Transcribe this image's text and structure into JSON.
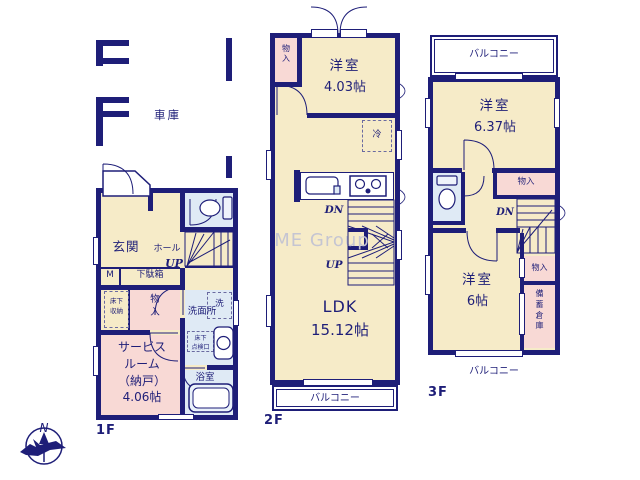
{
  "colors": {
    "wall": "#1e1e78",
    "room_cream": "#f6ebc8",
    "closet_pink": "#f8d9d5",
    "wet_blue": "#dfeaf5",
    "watermark_gray": "#c5c5d2"
  },
  "watermark": "ME Group",
  "compass": {
    "north": "N"
  },
  "f1": {
    "floor_label": "1F",
    "garage": "車庫",
    "genkan": "玄関",
    "hall": "ホール",
    "up": "UP",
    "meter": "M",
    "shoe_box": "下駄箱",
    "underfloor_storage": "床下\n収納",
    "closet": "物\n入",
    "service_room": "サービス\nルーム\n（納戸）\n4.06帖",
    "washer": "洗",
    "washroom": "洗面所",
    "underfloor_hatch": "床下\n点検口",
    "bathroom": "浴室"
  },
  "f2": {
    "floor_label": "2F",
    "closet": "物\n入",
    "room1": "洋室",
    "room1_size": "4.03帖",
    "fridge": "冷",
    "dn": "DN",
    "up": "UP",
    "ldk": "LDK",
    "ldk_size": "15.12帖",
    "balcony": "バルコニー"
  },
  "f3": {
    "floor_label": "3F",
    "balcony_top": "バルコニー",
    "room1": "洋室",
    "room1_size": "6.37帖",
    "closet1": "物入",
    "dn": "DN",
    "room2": "洋室",
    "room2_size": "6帖",
    "closet2": "物入",
    "storage": "備\n蓄\n倉\n庫",
    "balcony_bottom": "バルコニー"
  }
}
